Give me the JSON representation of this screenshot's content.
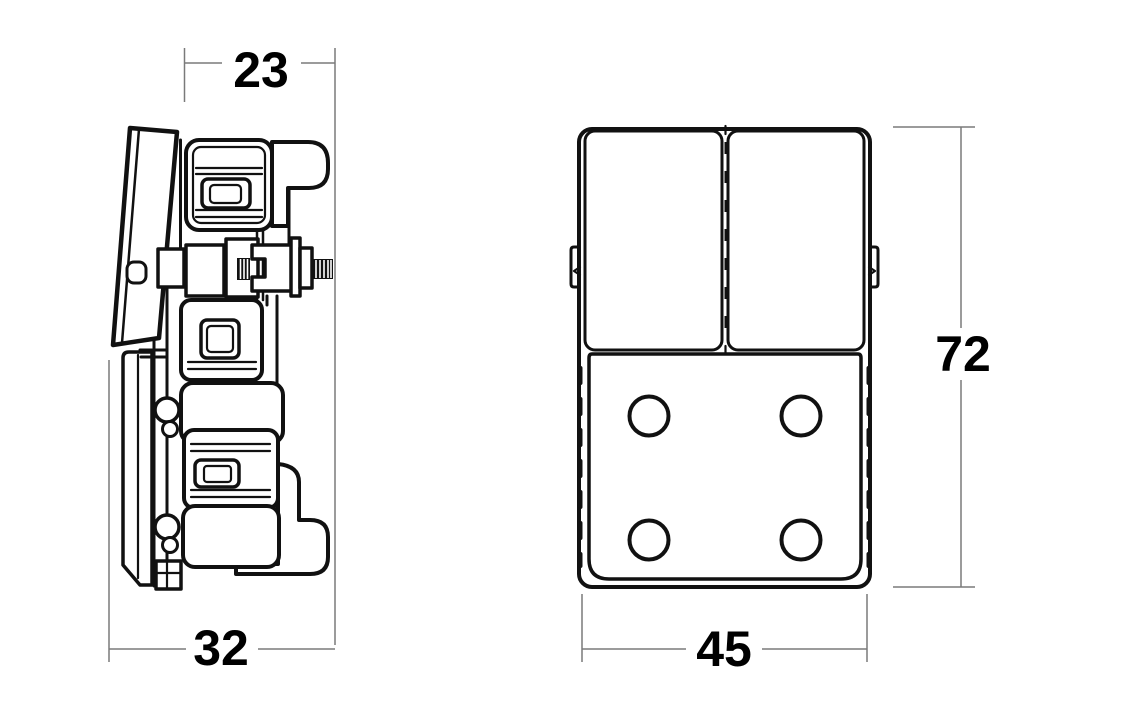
{
  "canvas": {
    "width": 1141,
    "height": 720,
    "background": "#ffffff"
  },
  "dimensions": {
    "side_top_depth": {
      "value": "23"
    },
    "side_overall_depth": {
      "value": "32"
    },
    "front_width": {
      "value": "45"
    },
    "front_height": {
      "value": "72"
    }
  },
  "colors": {
    "line": "#111111",
    "dimension": "#7a7a7a",
    "label_text": "#000000",
    "background": "#ffffff"
  }
}
